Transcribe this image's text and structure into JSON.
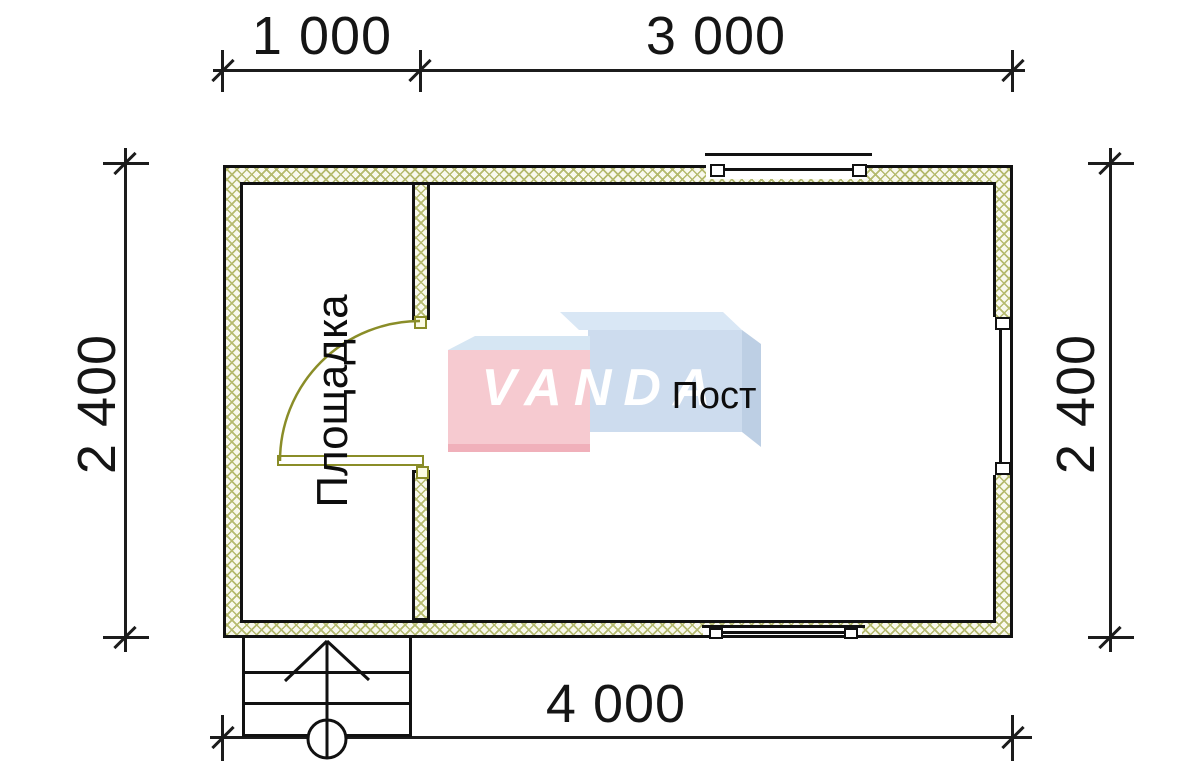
{
  "dimensions": {
    "top_segment_1": "1 000",
    "top_segment_2": "3 000",
    "bottom_total": "4 000",
    "left_height": "2 400",
    "right_height": "2 400"
  },
  "rooms": {
    "entry_platform_label": "Площадка",
    "post_room_label": "Пост"
  },
  "watermark": {
    "brand": "VANDA"
  },
  "colors": {
    "wall_hatch_line": "#b5ba6e",
    "wall_fill": "#f9f9ee",
    "door_olive": "#8a8d28",
    "logo_pink": "#f6cad0",
    "logo_pink_bottom": "#f0b0ba",
    "logo_blue_front": "#cddcee",
    "logo_blue_top": "#d9e7f5",
    "logo_blue_side": "#bdcfe4",
    "drawing_line": "#1c1c1c"
  }
}
